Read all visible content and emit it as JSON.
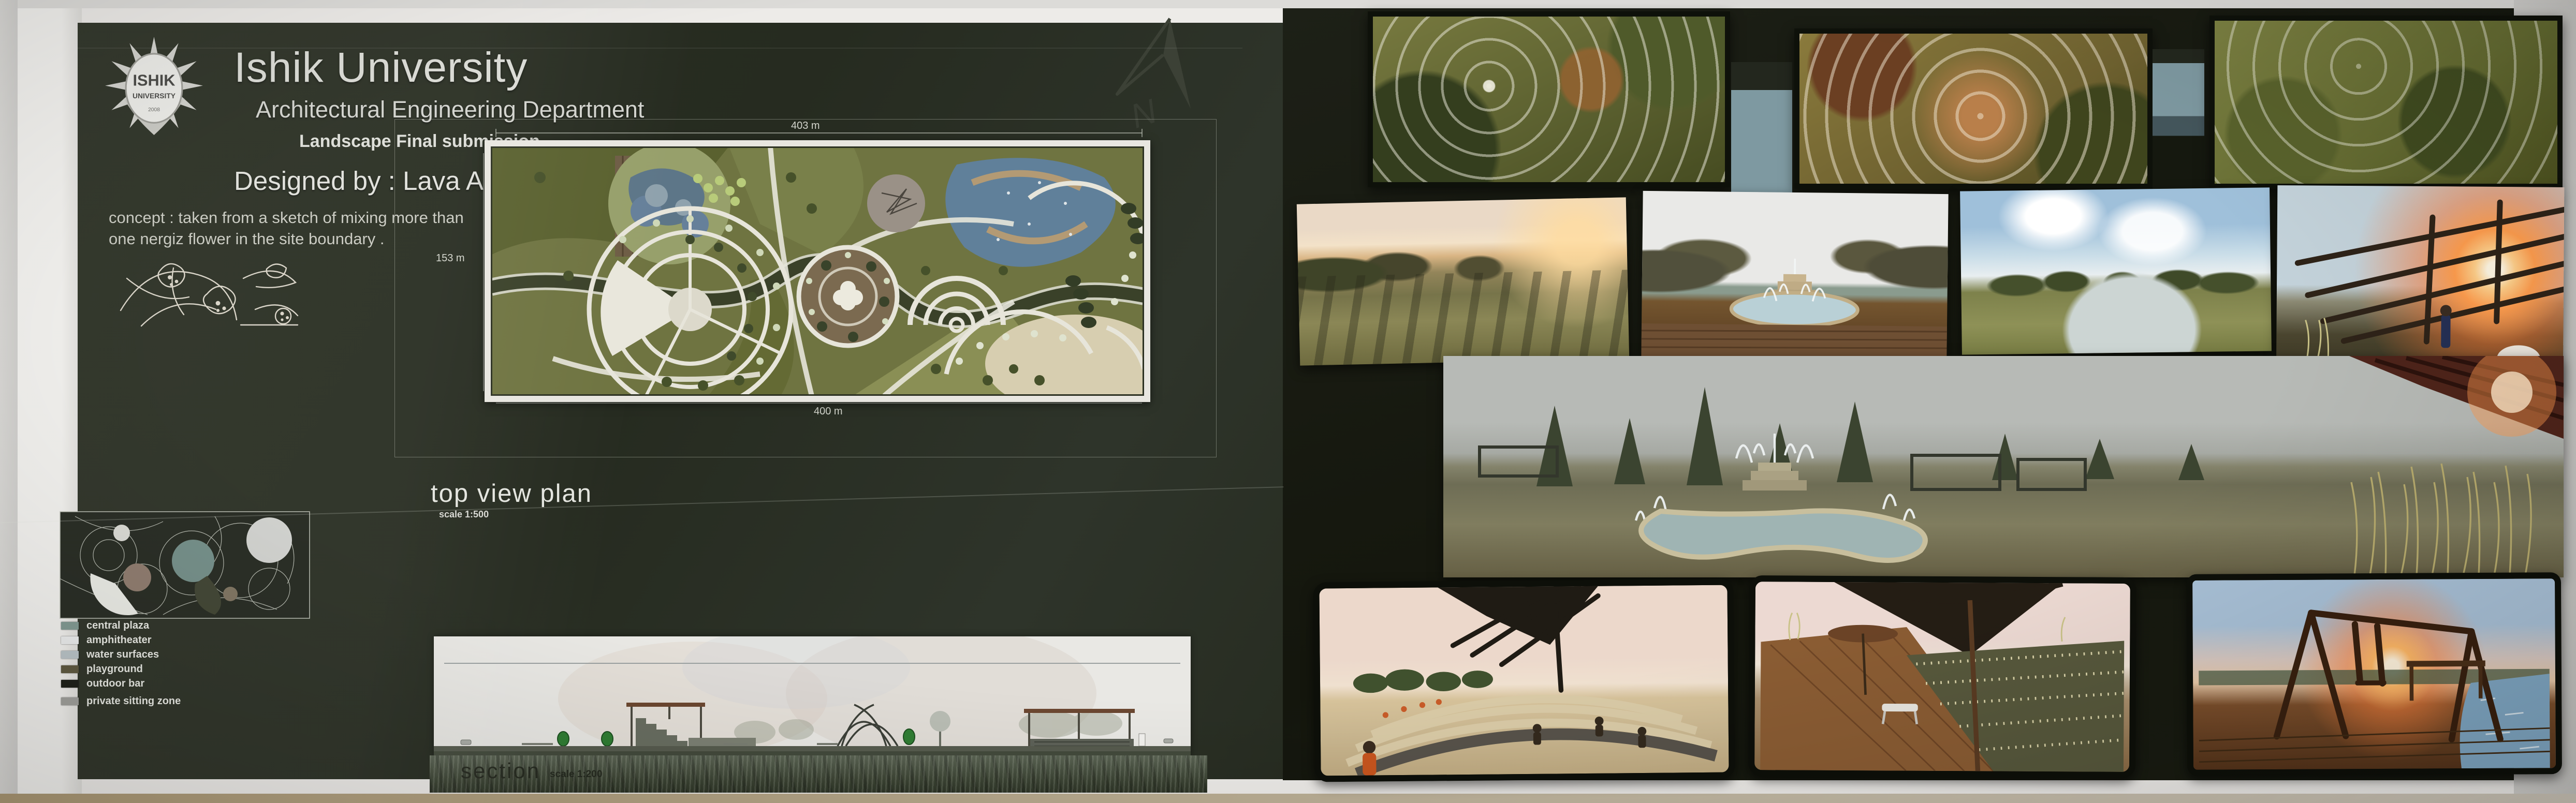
{
  "header": {
    "logo": {
      "line1": "ISHIK",
      "line2": "UNIVERSITY",
      "year": "2008"
    },
    "university": "Ishik University",
    "department": "Architectural Engineering Department",
    "submission": "Landscape Final submission",
    "designed_by": "Designed by : Lava Ahmed"
  },
  "concept": {
    "line1": "concept : taken from a sketch of mixing more than",
    "line2": "one nergiz flower in the site boundary ."
  },
  "plan": {
    "title": "top view plan",
    "scale_label": "scale 1:500",
    "dim_top": "403 m",
    "dim_left": "153 m",
    "dim_bottom": "400 m",
    "north_letter": "N"
  },
  "legend": {
    "items": [
      {
        "label": "central plaza",
        "color": "#7d968e"
      },
      {
        "label": "amphitheater",
        "color": "#eceded"
      },
      {
        "label": "water surfaces",
        "color": "#b8c2c6"
      },
      {
        "label": "playground",
        "color": "#575238"
      },
      {
        "label": "outdoor bar",
        "color": "#14160f"
      },
      {
        "label": "private sitting zone",
        "color": "#9d9d99"
      }
    ]
  },
  "section": {
    "title": "section",
    "scale_label": "scale 1:200"
  }
}
